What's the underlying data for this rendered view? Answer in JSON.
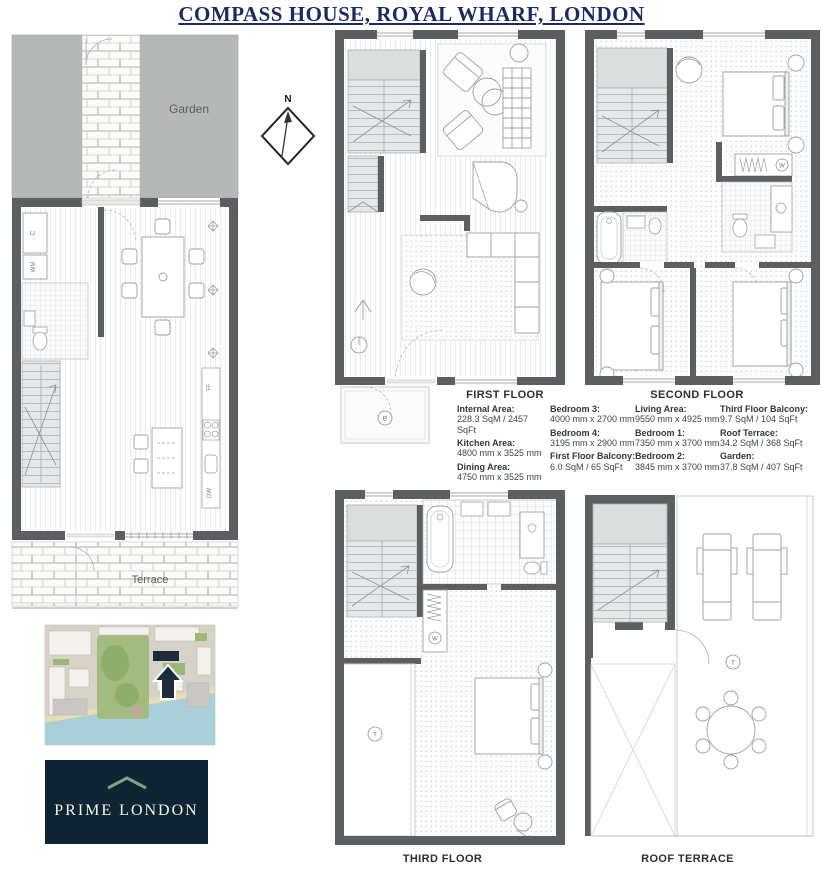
{
  "page": {
    "title": "COMPASS HOUSE, ROYAL WHARF, LONDON"
  },
  "compass": {
    "north": "N"
  },
  "ground_floor": {
    "garden_label": "Garden",
    "terrace_label": "Terrace",
    "cupboard": "C",
    "washing_machine": "WM",
    "fridge_freezer": "FF",
    "dishwasher": "DW"
  },
  "first_floor": {
    "balcony_symbol": "B"
  },
  "second_floor": {
    "wardrobe_symbol": "W"
  },
  "third_floor": {
    "label": "THIRD FLOOR",
    "wardrobe_symbol": "W",
    "terrace_symbol": "T"
  },
  "roof_terrace": {
    "label": "ROOF TERRACE",
    "terrace_symbol": "T"
  },
  "specs": {
    "first_floor": {
      "heading": "FIRST FLOOR",
      "col1": [
        {
          "label": "Internal Area:",
          "value": "228.3 SqM / 2457 SqFt"
        },
        {
          "label": "Kitchen Area:",
          "value": "4800 mm x 3525 mm"
        },
        {
          "label": "Dining Area:",
          "value": "4750 mm x 3525 mm"
        }
      ],
      "col2": [
        {
          "label": "Bedroom 3:",
          "value": "4000 mm x 2700 mm"
        },
        {
          "label": "Bedroom 4:",
          "value": "3195 mm x 2900 mm"
        },
        {
          "label": "First Floor Balcony:",
          "value": "6.0 SqM / 65 SqFt"
        }
      ]
    },
    "second_floor": {
      "heading": "SECOND FLOOR",
      "col1": [
        {
          "label": "Living Area:",
          "value": "9550 mm x 4925 mm"
        },
        {
          "label": "Bedroom 1:",
          "value": "7350 mm x 3700 mm"
        },
        {
          "label": "Bedroom 2:",
          "value": "3845 mm x 3700 mm"
        }
      ],
      "col2": [
        {
          "label": "Third Floor Balcony:",
          "value": "9.7 SqM / 104 SqFt"
        },
        {
          "label": "Roof Terrace:",
          "value": "34.2 SqM / 368 SqFt"
        },
        {
          "label": "Garden:",
          "value": "37.8 SqM / 407 SqFt"
        }
      ]
    }
  },
  "logo": {
    "name": "PRIME LONDON"
  },
  "colors": {
    "title_navy": "#1d2a5c",
    "wall_gray": "#5b5f62",
    "garden_gray": "#b6b8b7",
    "logo_navy": "#0e2433",
    "logo_green": "#7fa183",
    "map_water": "#a9cfd9",
    "map_green": "#9cb878",
    "map_arrow_navy": "#1d2c3c"
  }
}
